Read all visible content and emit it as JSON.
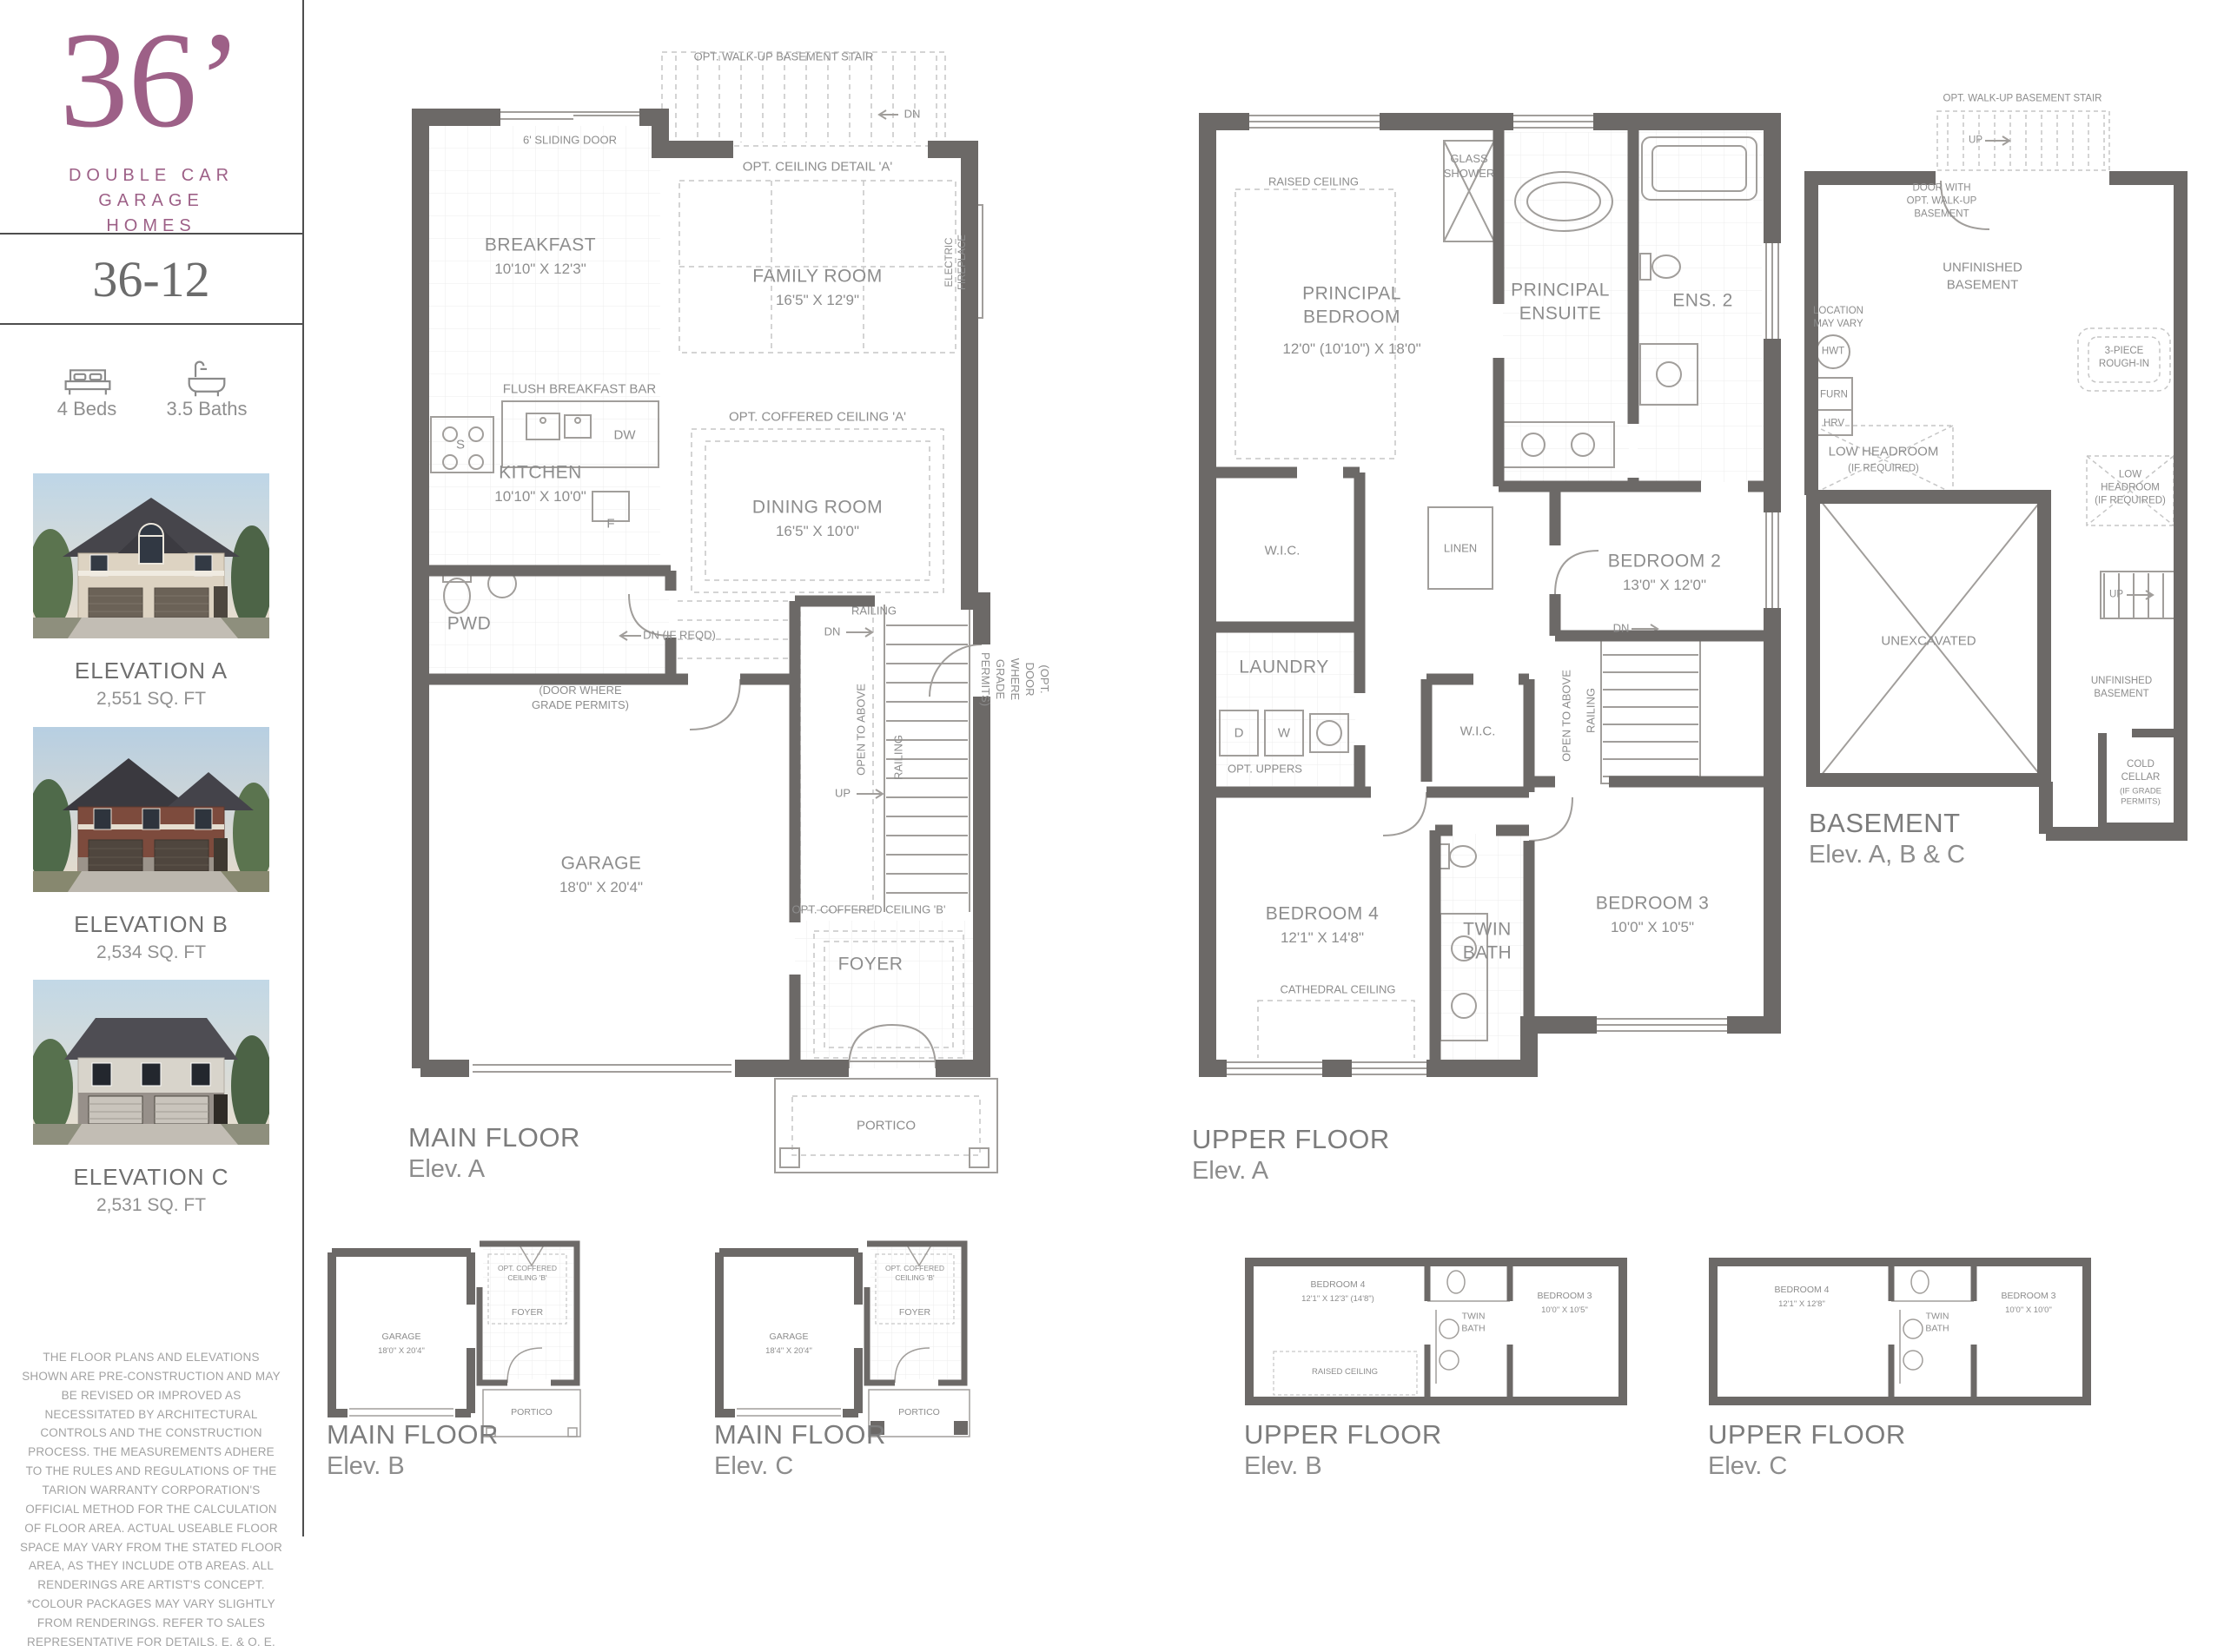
{
  "colors": {
    "brand_purple": "#9d6087",
    "wall_gray": "#6c6967",
    "label_gray": "#8d8d8d"
  },
  "sidebar": {
    "logo_number": "36’",
    "logo_sub": "DOUBLE CAR\nGARAGE\nHOMES",
    "model": "36-12",
    "beds_icon": "bed-icon",
    "baths_icon": "bathtub-icon",
    "beds": "4 Beds",
    "baths": "3.5 Baths",
    "elevations": [
      {
        "name": "ELEVATION A",
        "sqft": "2,551 SQ. FT"
      },
      {
        "name": "ELEVATION B",
        "sqft": "2,534 SQ. FT"
      },
      {
        "name": "ELEVATION C",
        "sqft": "2,531 SQ. FT"
      }
    ],
    "disclaimer": "THE FLOOR PLANS AND ELEVATIONS SHOWN ARE PRE-CONSTRUCTION AND MAY BE REVISED OR IMPROVED AS NECESSITATED BY ARCHITECTURAL CONTROLS AND THE CONSTRUCTION PROCESS. THE MEASUREMENTS ADHERE TO THE RULES AND REGULATIONS OF THE TARION WARRANTY CORPORATION'S OFFICIAL METHOD FOR THE CALCULATION OF FLOOR AREA. ACTUAL USEABLE FLOOR SPACE MAY VARY FROM THE STATED FLOOR AREA, AS THEY INCLUDE OTB AREAS. ALL RENDERINGS ARE ARTIST'S CONCEPT. *COLOUR PACKAGES MAY VARY SLIGHTLY FROM RENDERINGS. REFER TO SALES REPRESENTATIVE FOR DETAILS. E. & O. E."
  },
  "plans": {
    "main_a": {
      "title": "MAIN FLOOR",
      "elev": "Elev. A",
      "labels": {
        "opt_walkup": "OPT. WALK-UP BASEMENT STAIR",
        "dn_top": "DN",
        "sliding": "6' SLIDING DOOR",
        "ceiling_a": "OPT. CEILING DETAIL 'A'",
        "breakfast": "BREAKFAST",
        "breakfast_dim": "10'10\" X 12'3\"",
        "family": "FAMILY ROOM",
        "family_dim": "16'5\" X 12'9\"",
        "fireplace": "ELECTRIC FIREPLACE",
        "flush_bar": "FLUSH BREAKFAST BAR",
        "dw": "DW",
        "s": "S",
        "f": "F",
        "kitchen": "KITCHEN",
        "kitchen_dim": "10'10\" X 10'0\"",
        "coffered_a": "OPT. COFFERED CEILING 'A'",
        "dining": "DINING ROOM",
        "dining_dim": "16'5\" X 10'0\"",
        "pwd": "PWD",
        "dn_if_reqd": "DN (IF REQD)",
        "door_grade": "(DOOR WHERE\nGRADE PERMITS)",
        "railing_h": "RAILING",
        "dn_mid": "DN",
        "open_above": "OPEN TO ABOVE",
        "railing_v": "RAILING",
        "up": "UP",
        "opt_door_grade": "(OPT. DOOR WHERE\nGRADE PERMITS)",
        "garage": "GARAGE",
        "garage_dim": "18'0\" X 20'4\"",
        "coffered_b": "OPT. COFFERED CEILING 'B'",
        "foyer": "FOYER",
        "portico": "PORTICO"
      }
    },
    "upper_a": {
      "title": "UPPER FLOOR",
      "elev": "Elev. A",
      "labels": {
        "raised": "RAISED CEILING",
        "principal": "PRINCIPAL\nBEDROOM",
        "principal_dim": "12'0\" (10'10\")  X 18'0\"",
        "glass_shower": "GLASS\nSHOWER",
        "ensuite": "PRINCIPAL\nENSUITE",
        "ens2": "ENS. 2",
        "bedroom2": "BEDROOM 2",
        "bedroom2_dim": "13'0\" X 12'0\"",
        "wic": "W.I.C.",
        "linen": "LINEN",
        "laundry": "LAUNDRY",
        "d": "D",
        "w": "W",
        "opt_uppers": "OPT. UPPERS",
        "wic2": "W.I.C.",
        "dn": "DN",
        "railing": "RAILING",
        "open_above": "OPEN TO ABOVE",
        "bedroom4": "BEDROOM 4",
        "bedroom4_dim": "12'1\" X 14'8\"",
        "cathedral": "CATHEDRAL CEILING",
        "twin_bath": "TWIN\nBATH",
        "bedroom3": "BEDROOM 3",
        "bedroom3_dim": "10'0\" X 10'5\""
      }
    },
    "basement": {
      "title": "BASEMENT",
      "elev": "Elev. A, B & C",
      "labels": {
        "opt_walkup": "OPT. WALK-UP BASEMENT STAIR",
        "up1": "UP",
        "door_with": "DOOR WITH\nOPT. WALK-UP\nBASEMENT",
        "unfinished1": "UNFINISHED\nBASEMENT",
        "location": "LOCATION\nMAY VARY",
        "hwt": "HWT",
        "furn": "FURN",
        "hrv": "HRV",
        "rough_in": "3-PIECE\nROUGH-IN",
        "low_left": "LOW HEADROOM",
        "low_left_sub": "(IF REQUIRED)",
        "low_right": "LOW\nHEADROOM\n(IF REQUIRED)",
        "unexcavated": "UNEXCAVATED",
        "up2": "UP",
        "unfinished2": "UNFINISHED\nBASEMENT",
        "cold": "COLD\nCELLAR",
        "cold_sub": "(IF GRADE PERMITS)"
      }
    },
    "main_b": {
      "title": "MAIN FLOOR",
      "elev": "Elev. B",
      "labels": {
        "garage": "GARAGE",
        "garage_dim": "18'0\" X 20'4\"",
        "coffered": "OPT. COFFERED CEILING 'B'",
        "foyer": "FOYER",
        "portico": "PORTICO"
      }
    },
    "main_c": {
      "title": "MAIN FLOOR",
      "elev": "Elev. C",
      "labels": {
        "garage": "GARAGE",
        "garage_dim": "18'4\" X 20'4\"",
        "coffered": "OPT. COFFERED CEILING 'B'",
        "foyer": "FOYER",
        "portico": "PORTICO"
      }
    },
    "upper_b": {
      "title": "UPPER FLOOR",
      "elev": "Elev. B",
      "labels": {
        "bedroom4": "BEDROOM 4",
        "bedroom4_dim": "12'1\" X 12'3\" (14'8\")",
        "raised": "RAISED CEILING",
        "twin": "TWIN\nBATH",
        "bedroom3": "BEDROOM 3",
        "bedroom3_dim": "10'0\" X 10'5\""
      }
    },
    "upper_c": {
      "title": "UPPER FLOOR",
      "elev": "Elev. C",
      "labels": {
        "bedroom4": "BEDROOM 4",
        "bedroom4_dim": "12'1\" X 12'8\"",
        "twin": "TWIN\nBATH",
        "bedroom3": "BEDROOM 3",
        "bedroom3_dim": "10'0\" X 10'0\""
      }
    }
  }
}
